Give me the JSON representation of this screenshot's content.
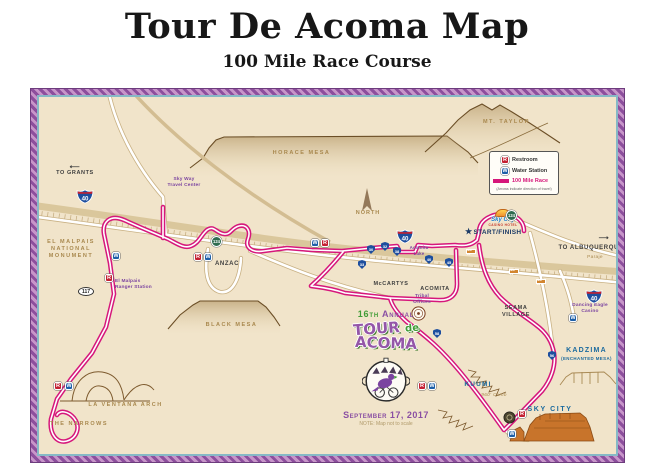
{
  "title": "Tour De Acoma Map",
  "subtitle": "100 Mile Race Course",
  "legend": {
    "restroom_abbr": "R",
    "restroom_label": "Restroom",
    "water_abbr": "W",
    "water_label": "Water Station",
    "race_label": "100 Mile Race",
    "note": "(Arrows indicate direction of travel)"
  },
  "map": {
    "north_label": "NORTH",
    "start_star": "★",
    "start_finish": "START/FINISH",
    "casino_logo_1": "Sky City",
    "casino_logo_2": "CASINO HOTEL",
    "labels": {
      "grants_arrow": "⟵",
      "to_grants": "TO GRANTS",
      "sky_way_1": "Sky Way",
      "sky_way_2": "Travel Center",
      "el_malpais_1": "EL MALPAIS",
      "el_malpais_2": "NATIONAL",
      "el_malpais_3": "MONUMENT",
      "ranger_1": "El Malpais",
      "ranger_2": "Ranger Station",
      "anzac": "ANZAC",
      "horace_mesa": "HORACE MESA",
      "mt_taylor": "MT. TAYLOR",
      "black_mesa": "BLACK MESA",
      "mccartys": "McCARTYS",
      "acomita": "ACOMITA",
      "tribal_1": "Tribal",
      "tribal_2": "Offices",
      "acomita_lake_1": "Acomita",
      "acomita_lake_2": "Lake",
      "seama_1": "SEAMA",
      "seama_2": "VILLAGE",
      "albuquerque_arrow": "⟶",
      "to_albuquerque": "TO ALBUQUERQUE",
      "paraje": "Paraje",
      "dancing_eagle_1": "Dancing Eagle",
      "dancing_eagle_2": "Casino",
      "kadzima": "KADZIMA",
      "kadzima_sub": "(ENCHANTED MESA)",
      "kuumi": "KUUMI",
      "climb": "960' Climb",
      "sky_city": "SKY CITY",
      "la_ventana": "LA VENTANA ARCH",
      "narrows": "THE NARROWS"
    },
    "shields": {
      "interstate": "40",
      "nm124": "124",
      "nm117": "117",
      "orange_badge": "NM 22",
      "tribal": [
        "30",
        "32",
        "38",
        "33",
        "40",
        "45",
        "56",
        "58"
      ]
    }
  },
  "logo": {
    "annual_num": "16th",
    "annual_word": "Annual",
    "tour": "TOUR",
    "de": "de",
    "acoma": "ACOMA",
    "date": "September 17, 2017",
    "note": "NOTE: Map not to scale"
  },
  "colors": {
    "route_pink": "#d6177b",
    "purple_label": "#7b44a0",
    "tan_label": "#a9894f",
    "blue_label": "#1b6a9e",
    "restroom_red": "#c42032",
    "water_blue": "#1d5fa8",
    "map_background": "#f1e4ca",
    "border_purple": "#8d4f9d"
  }
}
